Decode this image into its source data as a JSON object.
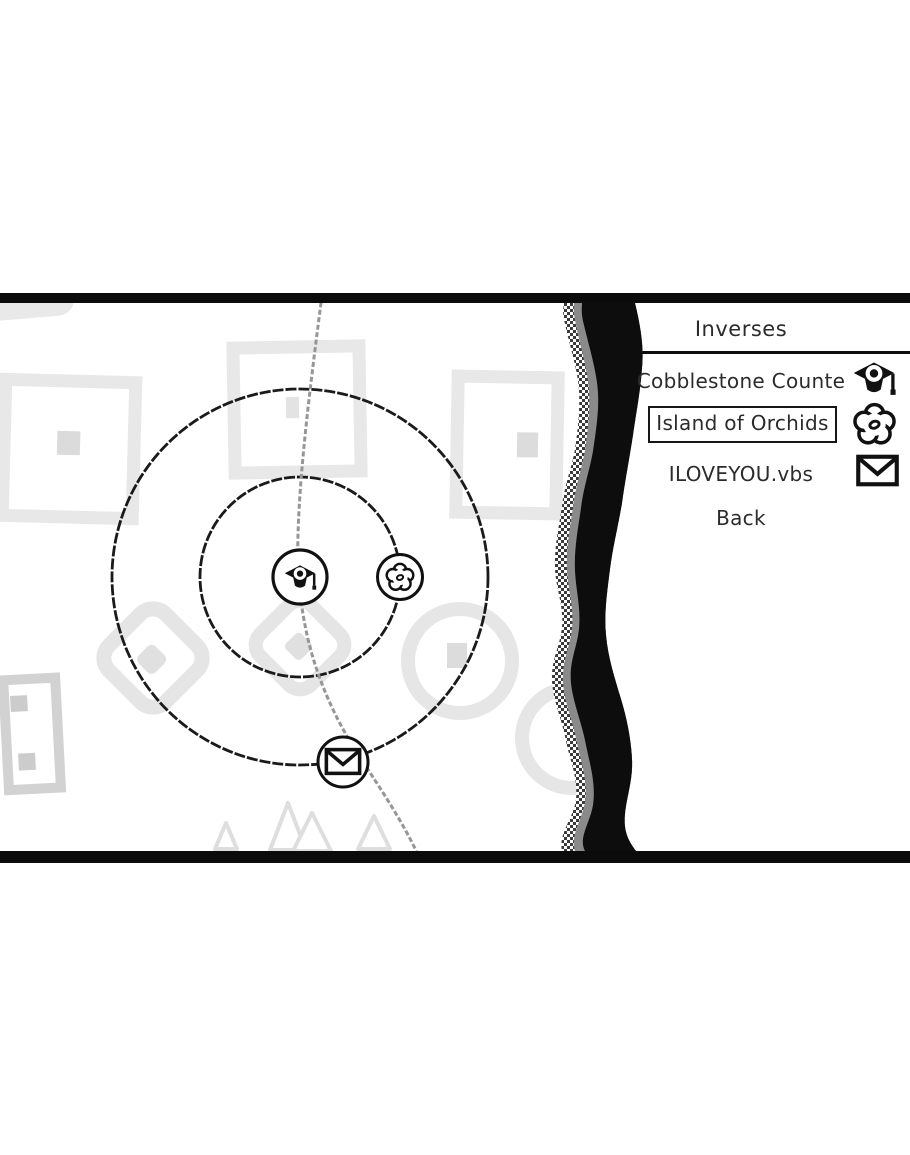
{
  "menu": {
    "title": "Inverses",
    "items": [
      {
        "label": "Cobblestone Counte",
        "icon": "graduation-cap",
        "selected": false
      },
      {
        "label": "Island of Orchids",
        "icon": "flower",
        "selected": true
      },
      {
        "label": "ILOVEYOU.vbs",
        "icon": "envelope",
        "selected": false
      },
      {
        "label": "Back",
        "icon": "",
        "selected": false
      }
    ]
  },
  "map": {
    "orbit_count": 2,
    "marker_icons": [
      "graduation-cap",
      "flower",
      "envelope"
    ]
  },
  "colors": {
    "ink": "#111111",
    "text": "#2b2b2b",
    "letterbox": "#0b0b0b",
    "path_gray": "#969696",
    "shape_gray": "#e7e7e7",
    "background": "#ffffff"
  }
}
